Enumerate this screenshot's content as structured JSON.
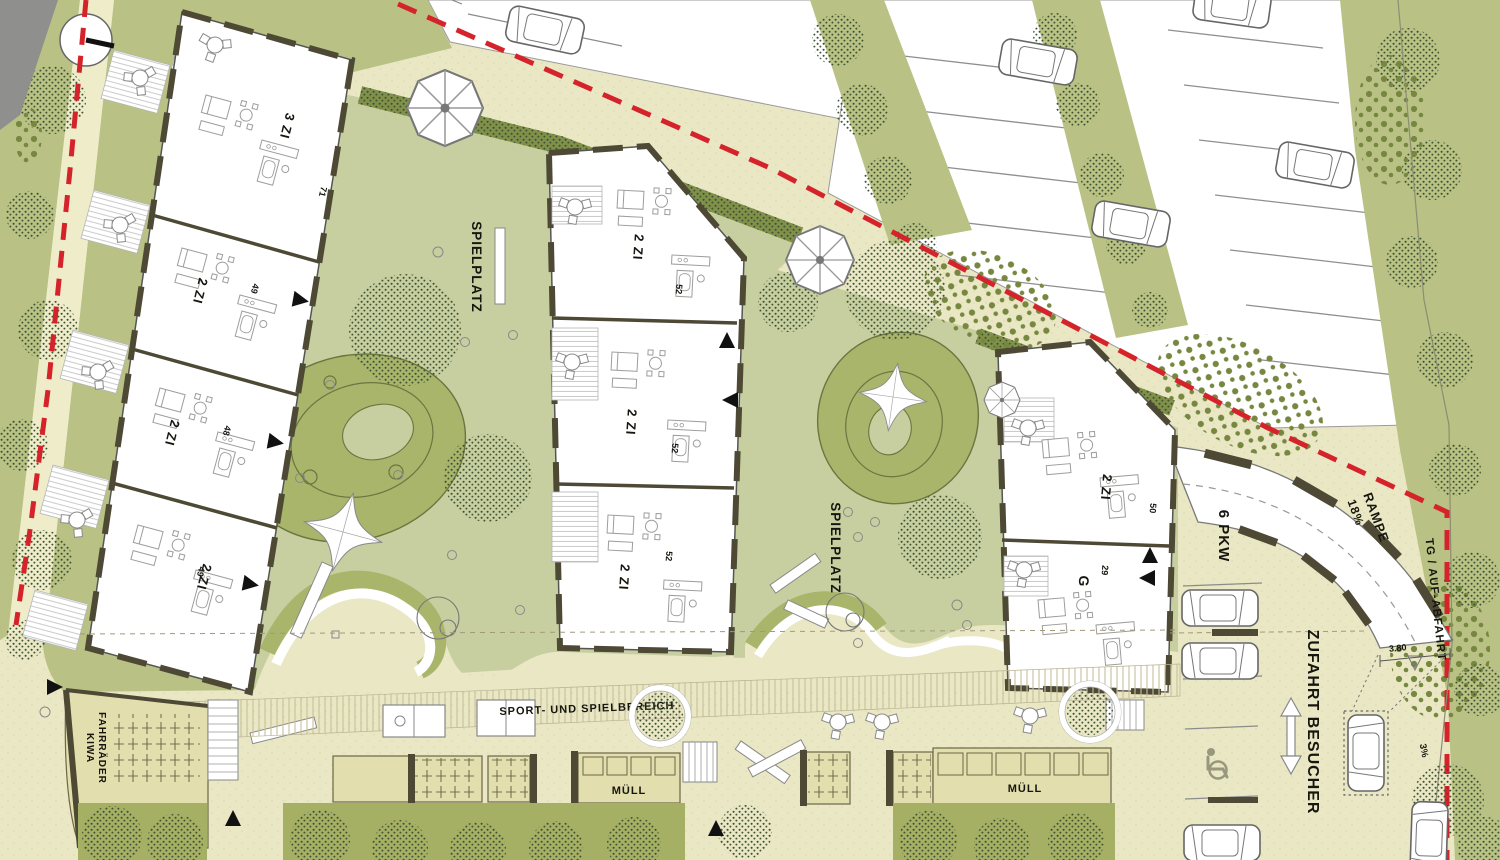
{
  "labels": {
    "spielplatz": "SPIELPLATZ",
    "sport_spielbereich": "SPORT- UND SPIELBEREICH",
    "muell": "MÜLL",
    "fahrraeder": "FAHRRÄDER",
    "kiwa": "KIWA",
    "rampe": "RAMPE",
    "rampe_gefaelle": "18%",
    "tg_zufahrt": "TG / AUF-ABFAHRT",
    "stellplaetze": "6 PKW",
    "zufahrt_besucher": "ZUFAHRT BESUCHER",
    "masz_3_80": "3.80",
    "gefaelle_3": "3%"
  },
  "buildings": {
    "left": {
      "units": [
        {
          "type": "3 ZI",
          "area": "71"
        },
        {
          "type": "2 ZI",
          "area": "49"
        },
        {
          "type": "2 ZI",
          "area": "48"
        },
        {
          "type": "2 ZI",
          "area": "49"
        }
      ]
    },
    "middle": {
      "units": [
        {
          "type": "2 ZI",
          "area": "52"
        },
        {
          "type": "2 ZI",
          "area": "52"
        },
        {
          "type": "2 ZI",
          "area": "52"
        }
      ]
    },
    "right": {
      "units": [
        {
          "type": "2 ZI",
          "area": "50"
        },
        {
          "type": "G",
          "area": "29"
        }
      ]
    }
  },
  "colors": {
    "paved": "#eae7c5",
    "lawn": "#b9c284",
    "courtyard": "#c7cfa0",
    "playground": "#a8b56b",
    "hedge": "#81914a",
    "bottom_lawn": "#a5b065",
    "boundary_red": "#d5232b",
    "wall": "#4d4935"
  }
}
